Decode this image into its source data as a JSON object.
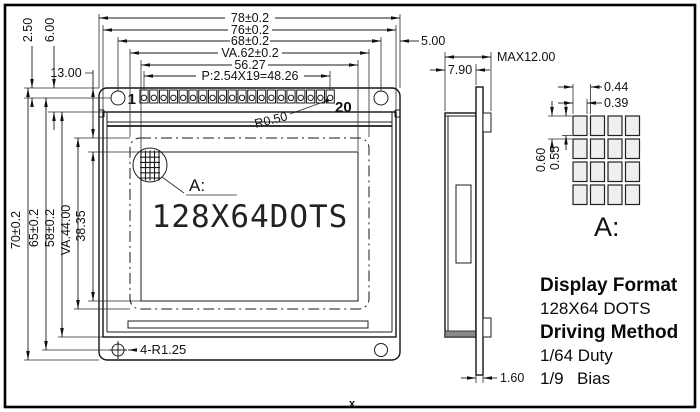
{
  "front": {
    "pin_first": "1",
    "pin_last": "20",
    "pin_count": 20,
    "radius_note": "R0.50",
    "detail_ref": "A:",
    "screen_text": "128X64DOTS",
    "mounting_note": "4-R1.25",
    "corner_mark": "x",
    "dims_top": {
      "overall_width": "78±0.2",
      "glass_width": "76±0.2",
      "hole_spacing_h": "68±0.2",
      "va_width": "VA.62±0.2",
      "aa_width": "56.27",
      "pin_pitch": "P:2.54X19=48.26",
      "edge_offset": "5.00"
    },
    "dims_left": {
      "hole_offset": "2.50",
      "glass_offset": "6.00",
      "va_offset": "13.00",
      "overall_height": "70±0.2",
      "hole_spacing_v": "65±0.2",
      "bezel_height": "58±0.2",
      "va_height": "VA.44.00",
      "aa_height": "38.35"
    }
  },
  "side": {
    "depth_module": "7.90",
    "depth_max": "MAX12.00",
    "pcb_thickness": "1.60"
  },
  "detail": {
    "dot_pitch_h": "0.44",
    "dot_width": "0.39",
    "dot_pitch_v": "0.60",
    "dot_height": "0.55",
    "label": "A:",
    "grid_rows": 4,
    "grid_cols": 4
  },
  "specs": {
    "format_title": "Display Format",
    "format_value": "128X64 DOTS",
    "driving_title": "Driving Method",
    "duty": "1/64 Duty",
    "bias_num": "1/9",
    "bias_word": "Bias"
  }
}
